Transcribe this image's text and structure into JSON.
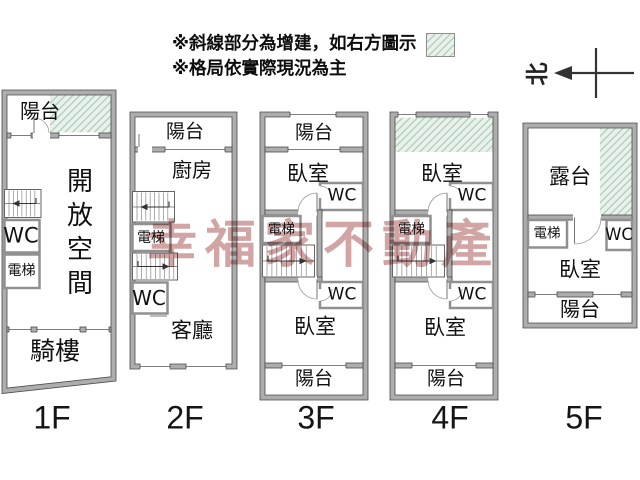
{
  "legend": {
    "line1": "※斜線部分為增建，如右方圖示",
    "line2": "※格局依實際現況為主"
  },
  "compass": {
    "north": "北"
  },
  "watermark": {
    "text": "幸福家不動產"
  },
  "colors": {
    "wall": "#adadad",
    "wall_edge": "#4a4a4a",
    "hatch_bg": "#e9f1ea",
    "hatch_line": "#8cbea0",
    "watermark": "#d2a5a5"
  },
  "floors": [
    {
      "label": "1F",
      "rooms": {
        "balcony": "陽台",
        "open_space": "開放空間",
        "wc": "WC",
        "elevator": "電梯",
        "arcade": "騎樓"
      }
    },
    {
      "label": "2F",
      "rooms": {
        "balcony": "陽台",
        "kitchen": "廚房",
        "elevator": "電梯",
        "wc": "WC",
        "living": "客廳"
      }
    },
    {
      "label": "3F",
      "rooms": {
        "balcony_top": "陽台",
        "bedroom_top": "臥室",
        "wc_top": "WC",
        "elevator": "電梯",
        "wc_bottom": "WC",
        "bedroom_bottom": "臥室",
        "balcony_bottom": "陽台"
      }
    },
    {
      "label": "4F",
      "rooms": {
        "bedroom_top": "臥室",
        "wc_top": "WC",
        "elevator": "電梯",
        "wc_bottom": "WC",
        "bedroom_bottom": "臥室",
        "balcony_bottom": "陽台"
      }
    },
    {
      "label": "5F",
      "rooms": {
        "terrace": "露台",
        "elevator": "電梯",
        "wc": "WC",
        "bedroom": "臥室",
        "balcony": "陽台"
      }
    }
  ]
}
